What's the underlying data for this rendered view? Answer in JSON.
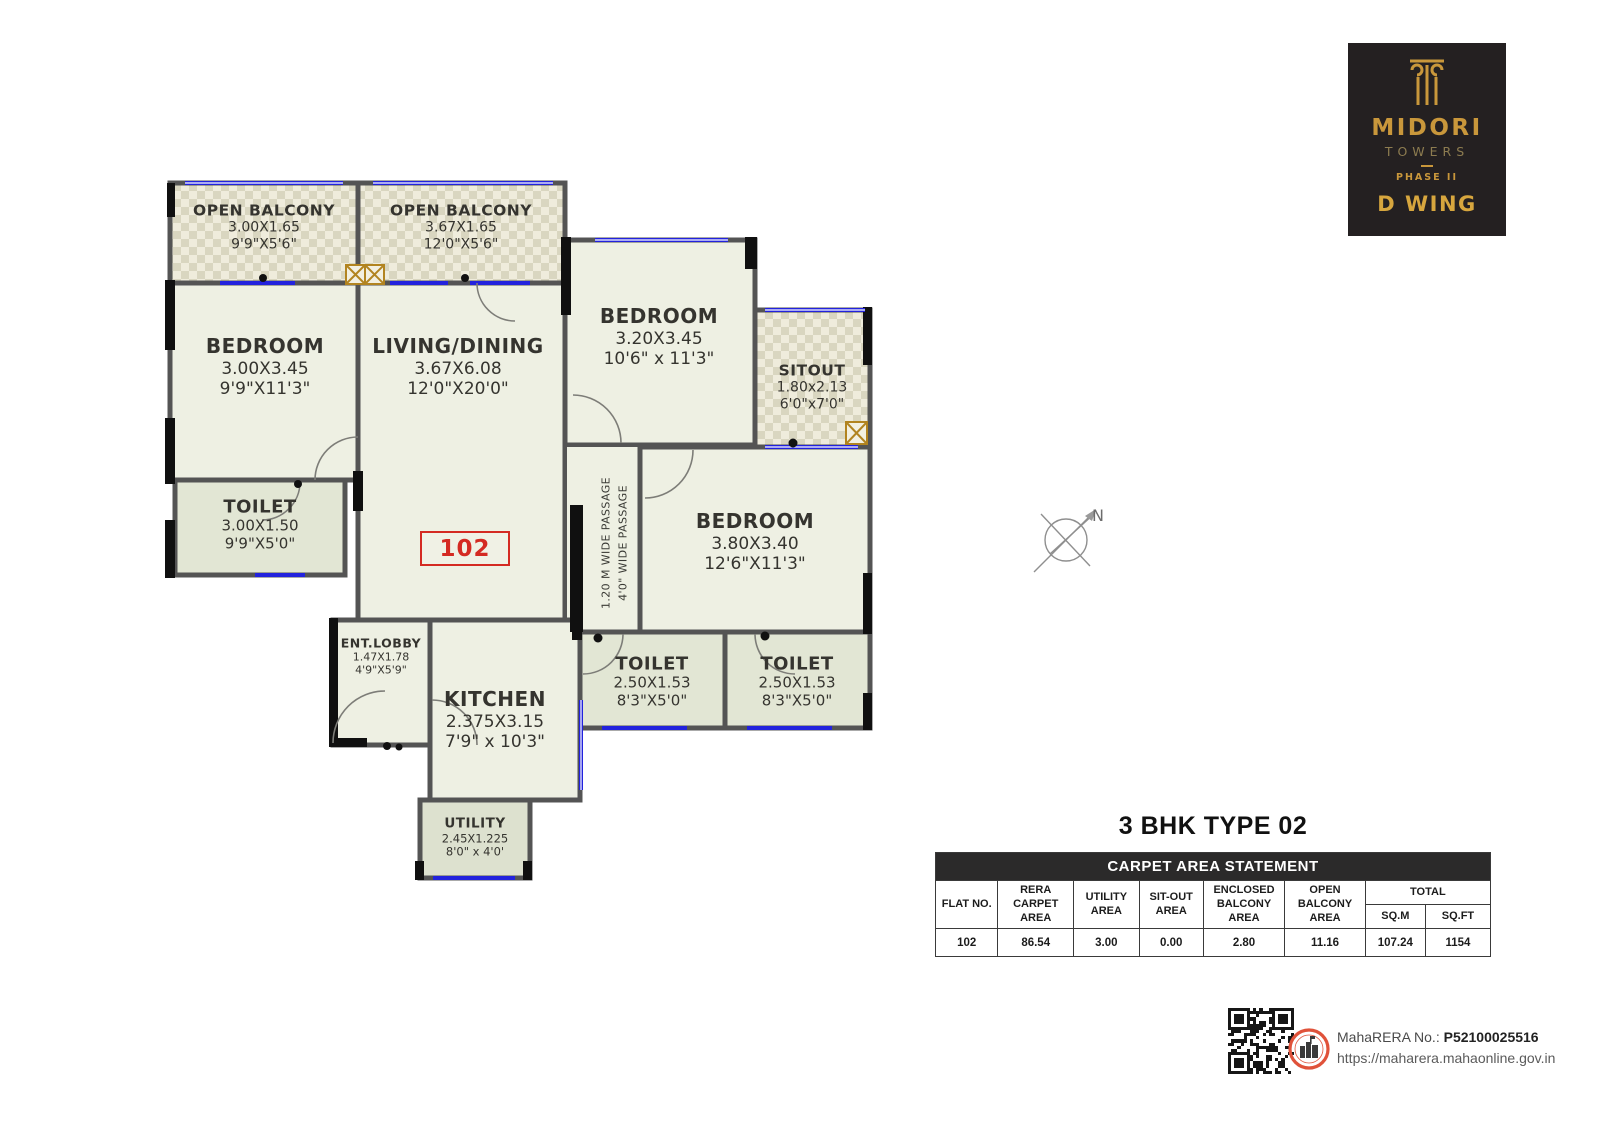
{
  "colors": {
    "gold": "#c9973b",
    "gold_bright": "#d7a63e",
    "red": "#d42a22",
    "wall": "#545454",
    "black_wall": "#101010",
    "window_blue": "#2222dd",
    "floor": "#eef0e3",
    "checker_dark": "#d9d6c0",
    "toilet_floor": "#e2e6d4",
    "table_header_bg": "#2b2a2a"
  },
  "logo": {
    "name": "MIDORI",
    "sub": "TOWERS",
    "phase": "PHASE II",
    "wing": "D WING"
  },
  "plan": {
    "flat_no": "102",
    "compass_label": "N",
    "passage_line1": "1.20 M WIDE PASSAGE",
    "passage_line2": "4'0\" WIDE PASSAGE",
    "rooms": {
      "balcony1": {
        "name": "OPEN BALCONY",
        "m": "3.00X1.65",
        "ft": "9'9\"X5'6\""
      },
      "balcony2": {
        "name": "OPEN BALCONY",
        "m": "3.67X1.65",
        "ft": "12'0\"X5'6\""
      },
      "bedroom1": {
        "name": "BEDROOM",
        "m": "3.00X3.45",
        "ft": "9'9\"X11'3\""
      },
      "living": {
        "name": "LIVING/DINING",
        "m": "3.67X6.08",
        "ft": "12'0\"X20'0\""
      },
      "bedroom2": {
        "name": "BEDROOM",
        "m": "3.20X3.45",
        "ft": "10'6\" x 11'3\""
      },
      "sitout": {
        "name": "SITOUT",
        "m": "1.80x2.13",
        "ft": "6'0\"x7'0\""
      },
      "toilet1": {
        "name": "TOILET",
        "m": "3.00X1.50",
        "ft": "9'9\"X5'0\""
      },
      "bedroom3": {
        "name": "BEDROOM",
        "m": "3.80X3.40",
        "ft": "12'6\"X11'3\""
      },
      "toilet2": {
        "name": "TOILET",
        "m": "2.50X1.53",
        "ft": "8'3\"X5'0\""
      },
      "toilet3": {
        "name": "TOILET",
        "m": "2.50X1.53",
        "ft": "8'3\"X5'0\""
      },
      "entlobby": {
        "name": "ENT.LOBBY",
        "m": "1.47X1.78",
        "ft": "4'9\"X5'9\""
      },
      "kitchen": {
        "name": "KITCHEN",
        "m": "2.375X3.15",
        "ft": "7'9\" x 10'3\""
      },
      "utility": {
        "name": "UTILITY",
        "m": "2.45X1.225",
        "ft": "8'0\" x 4'0'"
      }
    }
  },
  "details": {
    "title": "3 BHK TYPE 02",
    "table": {
      "header": "CARPET AREA STATEMENT",
      "col_flat": "FLAT NO.",
      "col_rera": "RERA CARPET AREA",
      "col_utility": "UTILITY AREA",
      "col_sitout": "SIT-OUT AREA",
      "col_encl": "ENCLOSED BALCONY AREA",
      "col_open": "OPEN BALCONY AREA",
      "col_total": "TOTAL",
      "col_sqm": "SQ.M",
      "col_sqft": "SQ.FT",
      "row": {
        "flat": "102",
        "rera": "86.54",
        "utility": "3.00",
        "sitout": "0.00",
        "encl": "2.80",
        "open": "11.16",
        "sqm": "107.24",
        "sqft": "1154"
      }
    }
  },
  "footer": {
    "rera_label": "MahaRERA No.:",
    "rera_no": "P52100025516",
    "url": "https://maharera.mahaonline.gov.in"
  }
}
